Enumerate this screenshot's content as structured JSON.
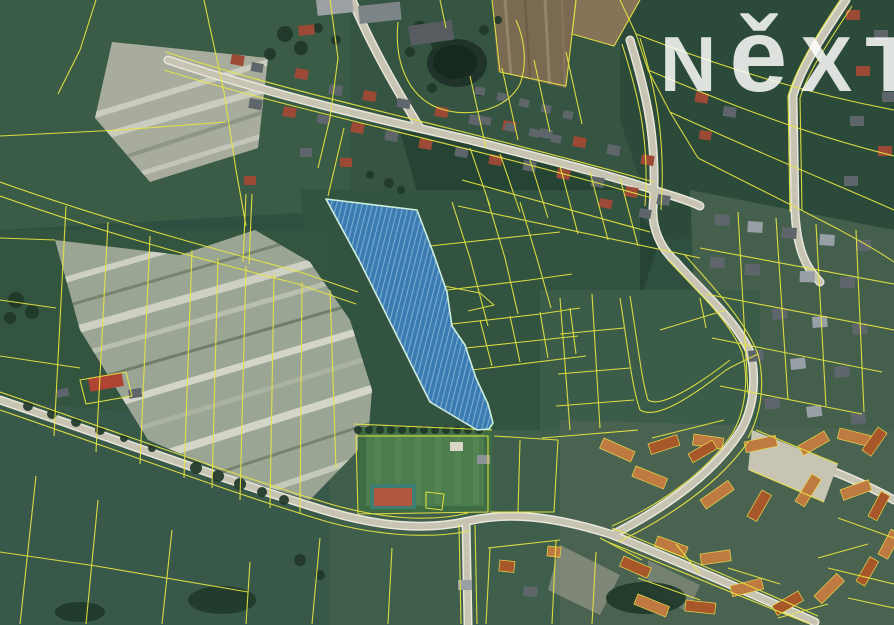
{
  "page": {
    "width": 894,
    "height": 625,
    "description": "Aerial cadastral map photo of a village with a highlighted land parcel"
  },
  "watermark": {
    "brand": "NEXT",
    "letters": [
      "N",
      "ě",
      "X",
      "T"
    ],
    "color": "rgba(255,255,255,0.84)"
  },
  "map": {
    "type": "aerial-cadastral",
    "highlighted_parcel": {
      "points": "326,199 417,210 433,252 447,292 452,326 465,345 476,378 488,404 493,423 489,429 477,430 430,402 394,330 360,262 340,225",
      "fill": "#3d85cc",
      "stroke": "#cdeedd",
      "hatch": "diagonal-lines"
    },
    "colors": {
      "cadastral_line": "#e8e642",
      "road": "#c8c4b4",
      "field_green": "#315340",
      "plowed_pale": "#9ba593",
      "water": "#1f332a"
    },
    "features": [
      "village",
      "fields",
      "roads",
      "pond",
      "sports-field",
      "tennis-court",
      "farm",
      "highlighted-parcel"
    ]
  }
}
